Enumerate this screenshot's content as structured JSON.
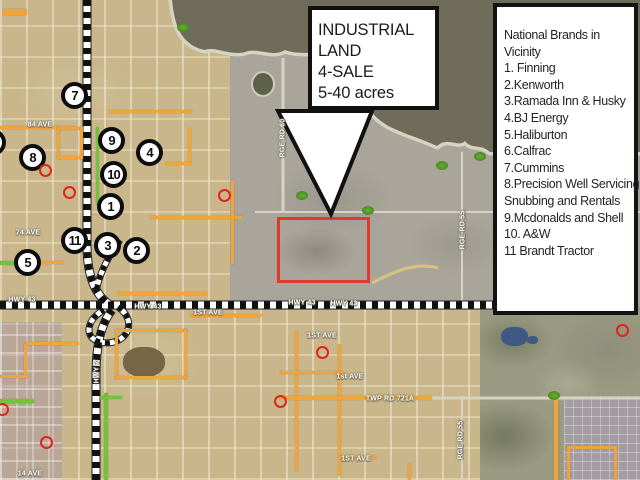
{
  "callout": {
    "lines": [
      "INDUSTRIAL",
      "LAND",
      "4-SALE",
      "5-40 acres"
    ]
  },
  "brands_box": {
    "lines": [
      "National Brands in",
      "Vicinity",
      "1. Finning",
      "2.Kenworth",
      "3.Ramada Inn & Husky",
      "4.BJ Energy",
      "5.Haliburton",
      "6.Calfrac",
      "7.Cummins",
      "8.Precision Well Servicing",
      "Snubbing and Rentals",
      "9.Mcdonalds and Shell",
      "10. A&W",
      "11 Brandt Tractor"
    ]
  },
  "map": {
    "colors": {
      "parcel_outline": "#e0392d",
      "orange_road": "#f0a43c",
      "green_road": "#72c23d",
      "water": "#6f6d5a",
      "red_marker": "#e02418"
    },
    "numbered_markers": [
      {
        "label": "7",
        "x": 75,
        "y": 96
      },
      {
        "label": "8",
        "x": 33,
        "y": 158
      },
      {
        "label": "9",
        "x": 112,
        "y": 141
      },
      {
        "label": "4",
        "x": 150,
        "y": 153
      },
      {
        "label": "10",
        "x": 114,
        "y": 175
      },
      {
        "label": "1",
        "x": 111,
        "y": 207
      },
      {
        "label": "11",
        "x": 75,
        "y": 241
      },
      {
        "label": "3",
        "x": 108,
        "y": 246
      },
      {
        "label": "2",
        "x": 137,
        "y": 251
      },
      {
        "label": "5",
        "x": 28,
        "y": 263
      },
      {
        "label": "6",
        "x": -7,
        "y": 143
      }
    ],
    "red_circle_markers": [
      {
        "x": 46,
        "y": 171
      },
      {
        "x": 70,
        "y": 193
      },
      {
        "x": 225,
        "y": 196
      },
      {
        "x": 323,
        "y": 353
      },
      {
        "x": 623,
        "y": 331
      },
      {
        "x": 47,
        "y": 443
      },
      {
        "x": 281,
        "y": 402
      },
      {
        "x": 3,
        "y": 410
      }
    ],
    "green_markers": [
      {
        "x": 183,
        "y": 28
      },
      {
        "x": 302,
        "y": 196
      },
      {
        "x": 368,
        "y": 211
      },
      {
        "x": 442,
        "y": 166
      },
      {
        "x": 480,
        "y": 157
      },
      {
        "x": 554,
        "y": 396
      }
    ],
    "road_labels": [
      {
        "text": "84 AVE",
        "x": 40,
        "y": 125,
        "rot": 0
      },
      {
        "text": "74 AVE",
        "x": 28,
        "y": 233,
        "rot": 0
      },
      {
        "text": "HWY 43",
        "x": 22,
        "y": 300,
        "rot": 0
      },
      {
        "text": "HWY 43",
        "x": 148,
        "y": 307,
        "rot": 0
      },
      {
        "text": "HWY 43",
        "x": 302,
        "y": 303,
        "rot": 0
      },
      {
        "text": "HWY 43",
        "x": 344,
        "y": 304,
        "rot": 0
      },
      {
        "text": "1ST AVE",
        "x": 208,
        "y": 313,
        "rot": 0
      },
      {
        "text": "1ST AVE",
        "x": 322,
        "y": 336,
        "rot": 0
      },
      {
        "text": "1st AVE",
        "x": 350,
        "y": 377,
        "rot": 0
      },
      {
        "text": "TWP RD 721A",
        "x": 390,
        "y": 399,
        "rot": 0
      },
      {
        "text": "1ST AVE",
        "x": 356,
        "y": 459,
        "rot": 0
      },
      {
        "text": "14 AVE",
        "x": 30,
        "y": 474,
        "rot": 0
      },
      {
        "text": "RGE RD 60",
        "x": 283,
        "y": 138,
        "rot": -90
      },
      {
        "text": "RGE RD 55",
        "x": 463,
        "y": 230,
        "rot": -90
      },
      {
        "text": "RGE RD 55",
        "x": 461,
        "y": 440,
        "rot": -90
      },
      {
        "text": "HWY 2",
        "x": 97,
        "y": 372,
        "rot": -90
      }
    ]
  }
}
